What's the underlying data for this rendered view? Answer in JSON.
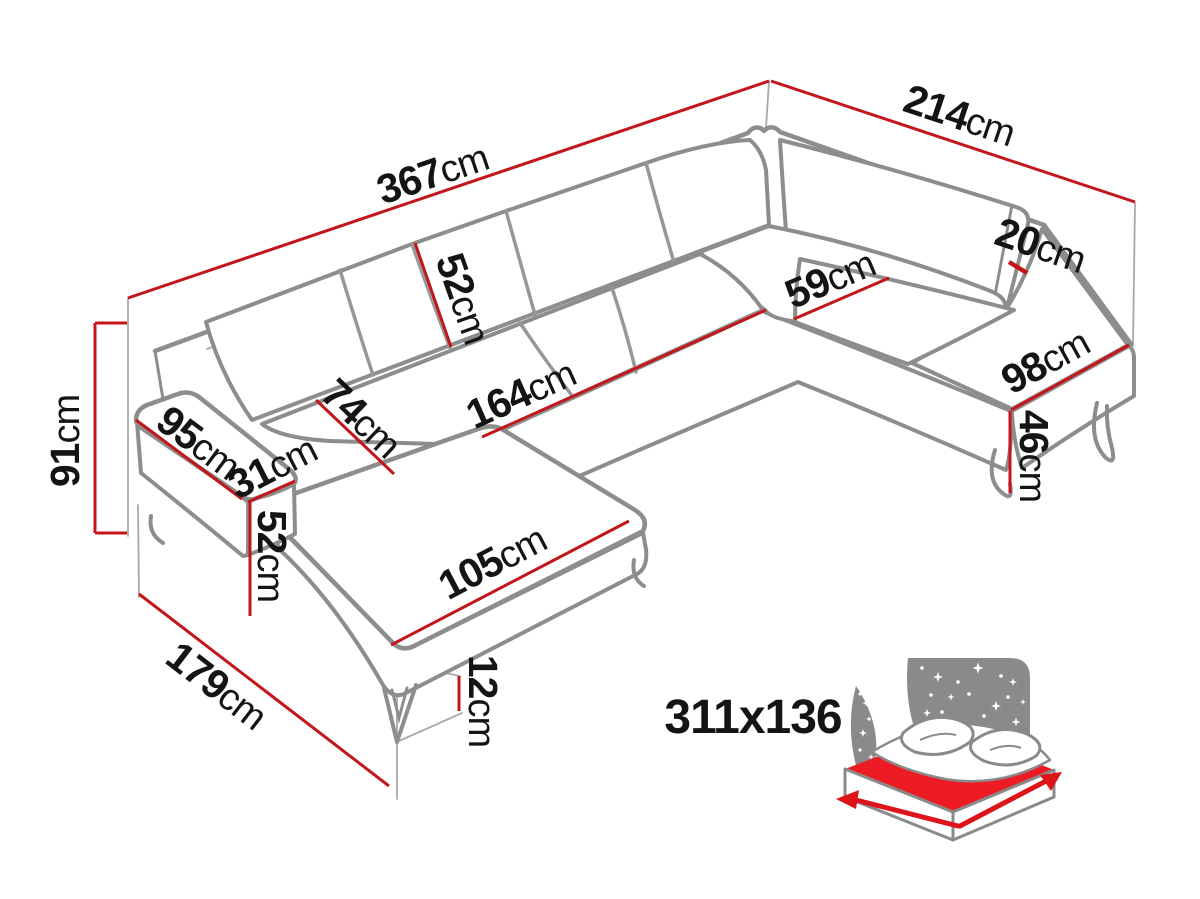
{
  "diagram": {
    "colors": {
      "dimension_line": "#c2161b",
      "sofa_outline": "#8d8d8d",
      "icon_gray": "#8a8a8a",
      "mattress_red": "#ed1c24",
      "label_text": "#141414"
    },
    "dimensions": {
      "total_width_left": {
        "value": "367",
        "unit": "cm"
      },
      "total_width_right": {
        "value": "214",
        "unit": "cm"
      },
      "total_height": {
        "value": "91",
        "unit": "cm"
      },
      "backrest_cushion_height": {
        "value": "52",
        "unit": "cm"
      },
      "seat_depth": {
        "value": "59",
        "unit": "cm"
      },
      "backrest_thickness": {
        "value": "20",
        "unit": "cm"
      },
      "open_end_width": {
        "value": "98",
        "unit": "cm"
      },
      "seat_height": {
        "value": "46",
        "unit": "cm"
      },
      "seat_front_length": {
        "value": "164",
        "unit": "cm"
      },
      "chaise_seat_width": {
        "value": "74",
        "unit": "cm"
      },
      "armrest_length": {
        "value": "95",
        "unit": "cm"
      },
      "armrest_width": {
        "value": "31",
        "unit": "cm"
      },
      "armrest_height": {
        "value": "52",
        "unit": "cm"
      },
      "chaise_front_length": {
        "value": "105",
        "unit": "cm"
      },
      "leg_height": {
        "value": "12",
        "unit": "cm"
      },
      "chaise_total_depth": {
        "value": "179",
        "unit": "cm"
      }
    },
    "sleeping_area": {
      "label": "311x136"
    },
    "icons": {
      "sleeping_function": "sofa-bed-sleeping-area-icon"
    }
  }
}
